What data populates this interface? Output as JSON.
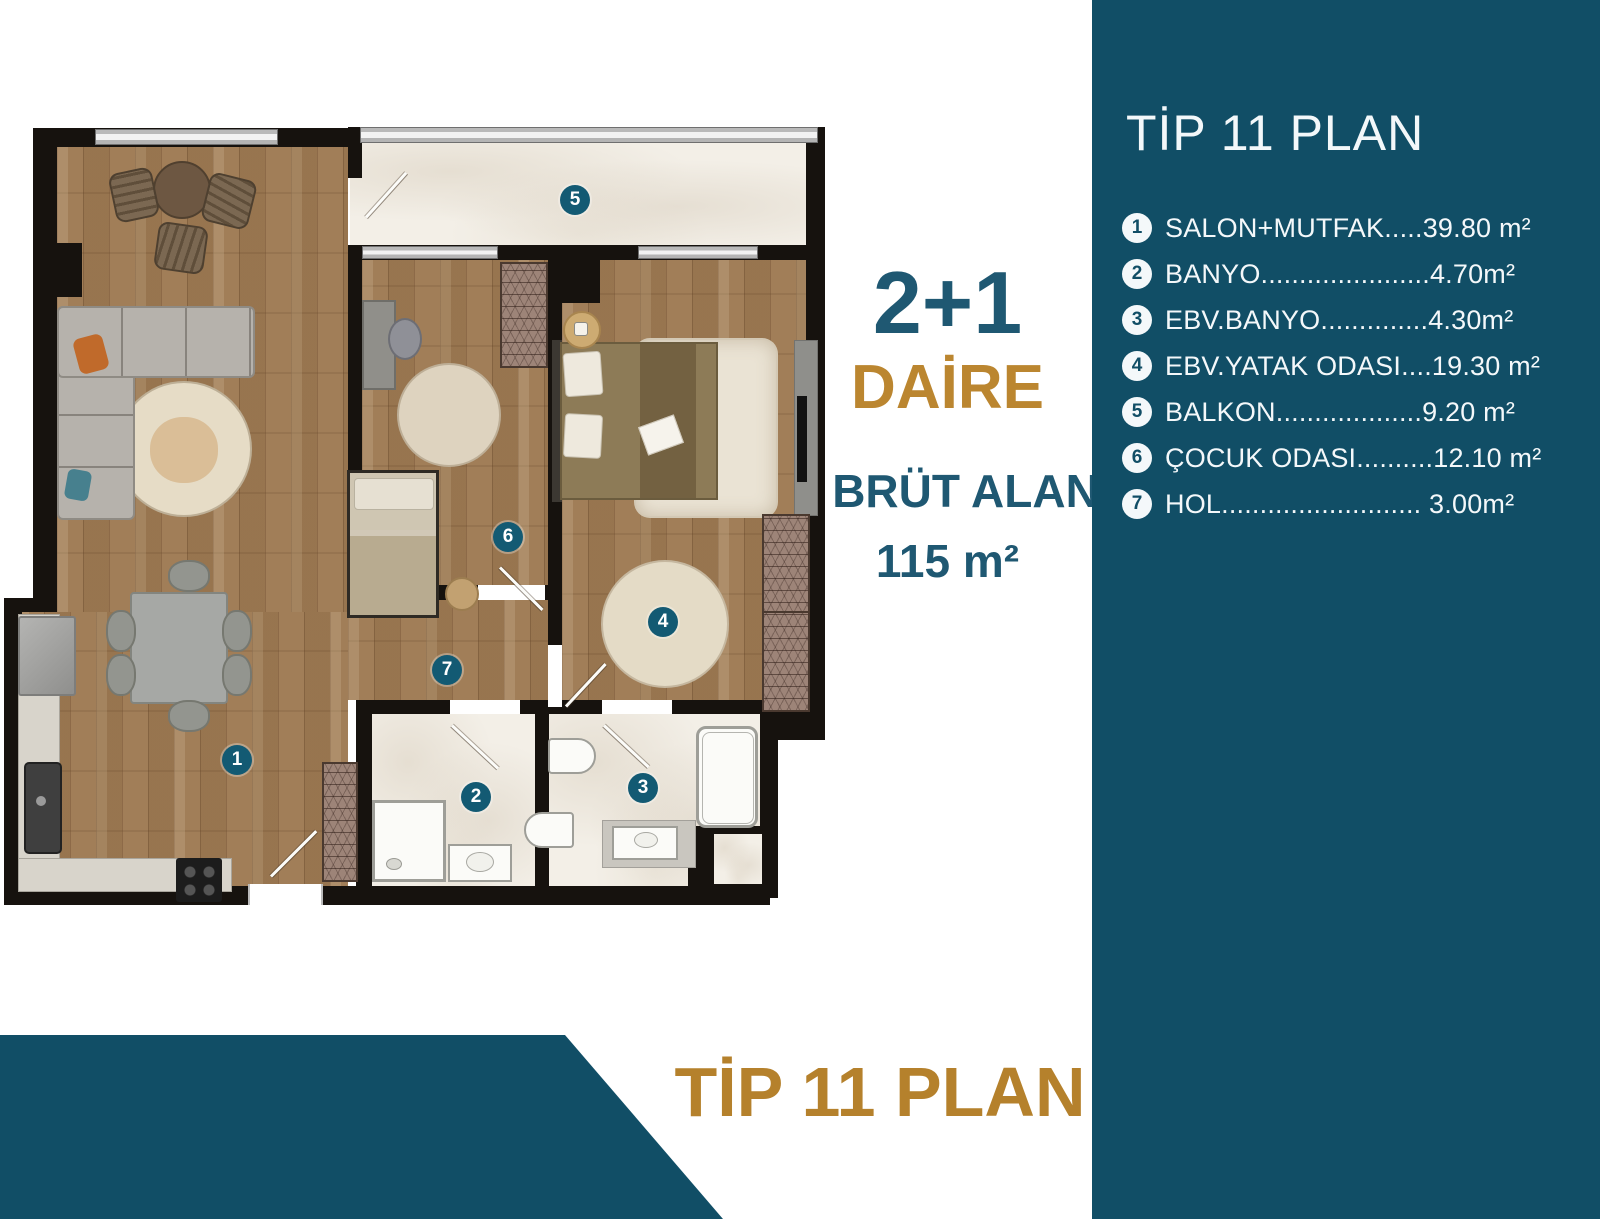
{
  "sidebar": {
    "title": "TİP 11 PLAN",
    "rooms": [
      {
        "num": "1",
        "label": "SALON+MUTFAK.....39.80 m²"
      },
      {
        "num": "2",
        "label": "BANYO......................4.70m²"
      },
      {
        "num": "3",
        "label": "EBV.BANYO..............4.30m²"
      },
      {
        "num": "4",
        "label": "EBV.YATAK ODASI....19.30 m²"
      },
      {
        "num": "5",
        "label": "BALKON...................9.20 m²"
      },
      {
        "num": "6",
        "label": "ÇOCUK ODASI..........12.10 m²"
      },
      {
        "num": "7",
        "label": "HOL.......................... 3.00m²"
      }
    ]
  },
  "info": {
    "layout": "2+1",
    "unit": "DAİRE",
    "gross_label": "BRÜT ALAN",
    "gross_area": "115 m²"
  },
  "footer": {
    "title": "TİP 11 PLAN"
  },
  "plan": {
    "markers": [
      "1",
      "2",
      "3",
      "4",
      "5",
      "6",
      "7"
    ]
  },
  "colors": {
    "teal": "#114e66",
    "gold": "#b5812c",
    "marker_teal": "#135a73",
    "wood": "#c8b092",
    "marble": "#f3efe7"
  }
}
